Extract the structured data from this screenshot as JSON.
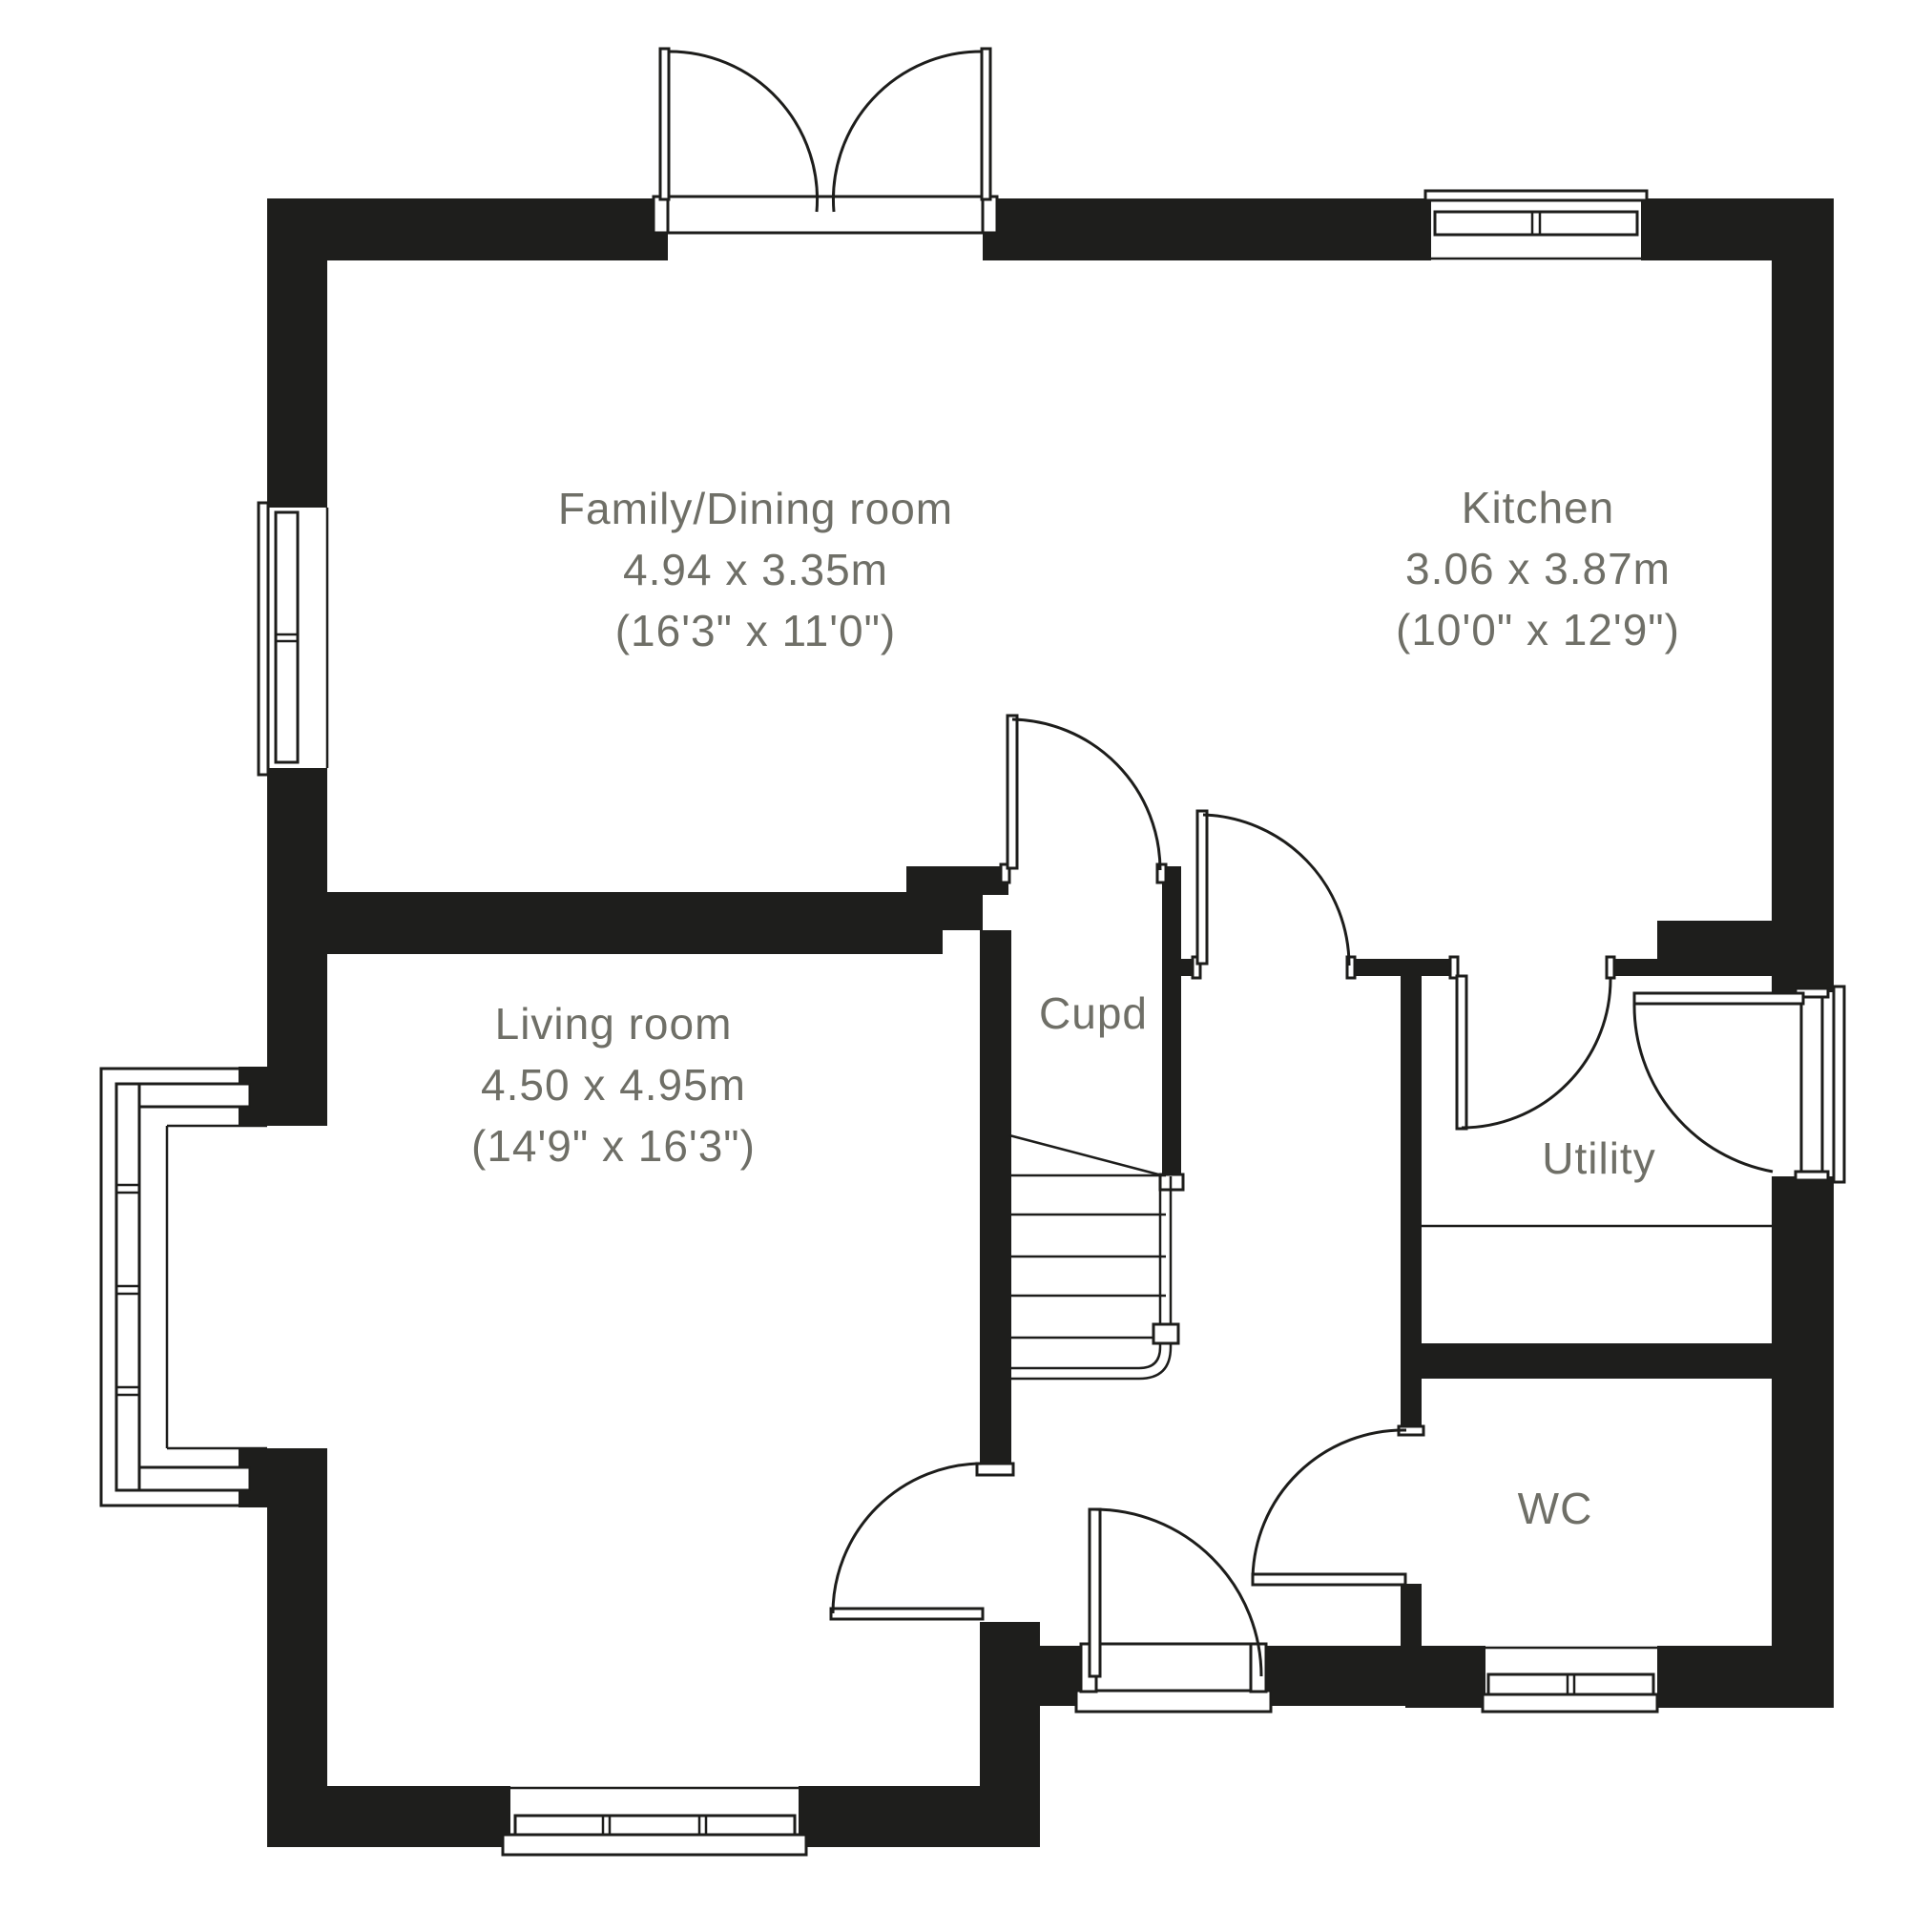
{
  "colors": {
    "wall": "#1e1e1c",
    "line": "#1d1d1b",
    "label": "#6f6f67",
    "background": "#ffffff"
  },
  "rooms": {
    "family_dining": {
      "name": "Family/Dining room",
      "size_metric": "4.94 x 3.35m",
      "size_imperial": "(16'3\" x 11'0\")"
    },
    "kitchen": {
      "name": "Kitchen",
      "size_metric": "3.06 x 3.87m",
      "size_imperial": "(10'0\" x 12'9\")"
    },
    "living": {
      "name": "Living room",
      "size_metric": "4.50 x 4.95m",
      "size_imperial": "(14'9\" x 16'3\")"
    },
    "cupboard": {
      "name": "Cupd"
    },
    "utility": {
      "name": "Utility"
    },
    "wc": {
      "name": "WC"
    }
  }
}
